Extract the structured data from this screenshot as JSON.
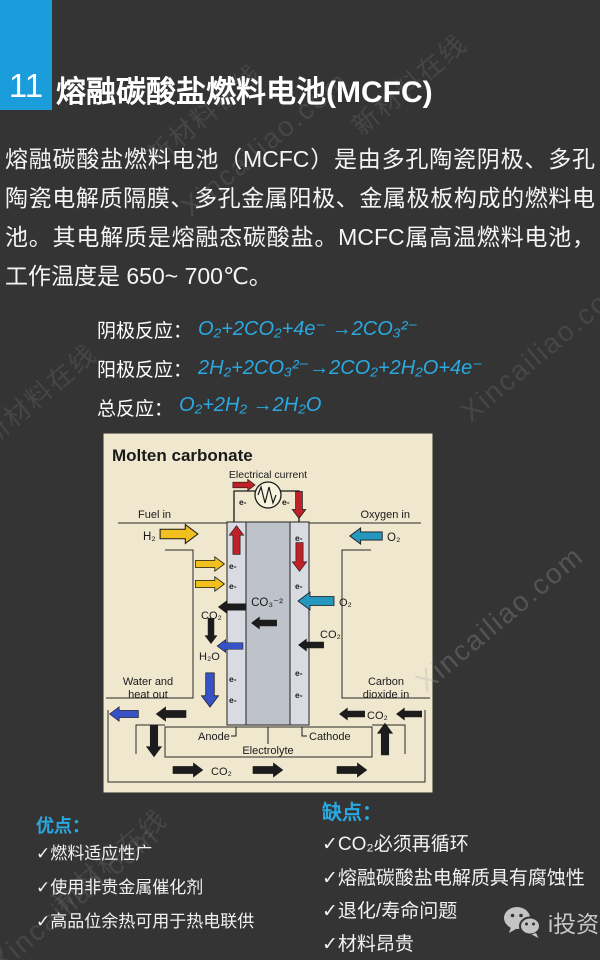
{
  "header": {
    "number": "11",
    "title": "熔融碳酸盐燃料电池(MCFC)"
  },
  "intro": "熔融碳酸盐燃料电池（MCFC）是由多孔陶瓷阴极、多孔陶瓷电解质隔膜、多孔金属阳极、金属极板构成的燃料电池。其电解质是熔融态碳酸盐。MCFC属高温燃料电池，工作温度是 650~ 700℃。",
  "reactions": {
    "rows": [
      {
        "label": "阴极反应：",
        "equation": "O₂+2CO₂+4e⁻ →2CO₃²⁻"
      },
      {
        "label": "阳极反应：",
        "equation": "2H₂+2CO₃²⁻→2CO₂+2H₂O+4e⁻"
      },
      {
        "label": "总反应：",
        "equation": "O₂+2H₂ →2H₂O"
      }
    ]
  },
  "diagram": {
    "title": "Molten carbonate",
    "electrical_current": "Electrical current",
    "fuel_in": "Fuel in",
    "oxygen_in": "Oxygen in",
    "h2": "H₂",
    "o2": "O₂",
    "co2": "CO₂",
    "h2o": "H₂O",
    "co3": "CO₃⁻²",
    "e": "e-",
    "water_out_1": "Water and",
    "water_out_2": "heat out",
    "co2_in_1": "Carbon",
    "co2_in_2": "dioxide in",
    "anode": "Anode",
    "electrolyte": "Electrolyte",
    "cathode": "Cathode"
  },
  "pros": {
    "heading": "优点：",
    "items": [
      "✓燃料适应性广",
      "✓使用非贵金属催化剂",
      "✓高品位余热可用于热电联供"
    ]
  },
  "cons": {
    "heading": "缺点：",
    "items": [
      "✓CO₂必须再循环",
      "✓熔融碳酸盐电解质具有腐蚀性",
      "✓退化/寿命问题",
      "✓材料昂贵"
    ]
  },
  "footer": {
    "brand": "i投资"
  },
  "watermarks": {
    "cn": "新材料在线",
    "en": "Xincailiao.com"
  },
  "colors": {
    "slide_bg": "#343434",
    "accent_blue": "#2AA9E1",
    "number_box_blue": "#1B9CDB",
    "diagram_bg": "#EFE8CF",
    "arrow_yellow": "#F2C01E",
    "arrow_teal": "#2596BE",
    "arrow_blue": "#3752C5",
    "arrow_red": "#C02028",
    "arrow_black": "#1C1C1C"
  }
}
